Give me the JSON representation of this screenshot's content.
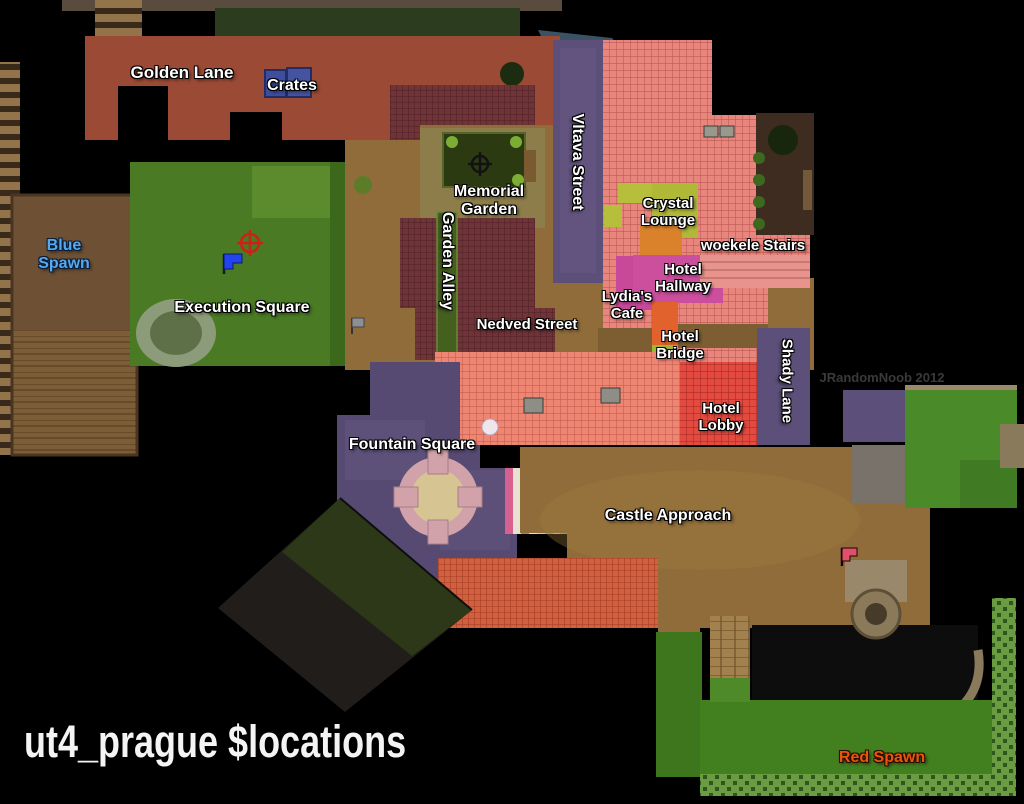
{
  "map": {
    "title": "ut4_prague $locations",
    "watermark": "JRandomNoob 2012"
  },
  "labels": {
    "golden_lane": "Golden Lane",
    "crates": "Crates",
    "blue_spawn": "Blue Spawn",
    "memorial_garden": "Memorial Garden",
    "garden_alley": "Garden Alley",
    "vltava_street": "Vltava Street",
    "crystal_lounge": "Crystal Lounge",
    "woekele_stairs": "woekele Stairs",
    "hotel_hallway": "Hotel Hallway",
    "lydias_cafe": "Lydia's Cafe",
    "nedved_street": "Nedved Street",
    "execution_square": "Execution Square",
    "hotel_bridge": "Hotel Bridge",
    "shady_lane": "Shady Lane",
    "hotel_lobby": "Hotel Lobby",
    "fountain_square": "Fountain Square",
    "castle_approach": "Castle Approach",
    "red_spawn": "Red Spawn"
  },
  "icons": {
    "blue_flag": "blue-flag-marker",
    "red_flag": "red-flag-marker",
    "neutral_flag": "gray-flag-marker",
    "red_crosshair": "red-target-marker",
    "black_crosshair": "black-target-marker"
  },
  "colors": {
    "label_text": "#ffffff",
    "blue_spawn_text": "#55aaee",
    "red_spawn_text": "#e8560e",
    "watermark_text": "#3a3a3a",
    "golden_lane_roof": "#9b4a35",
    "hotel_roof_pink": "#e8867e",
    "lobby_red": "#e34a40",
    "street_purple": "#5c4f79",
    "plaza_purple": "#564a72",
    "grass_green": "#4a7a24",
    "dirt_brown": "#8f6c3a",
    "background": "#000000"
  }
}
